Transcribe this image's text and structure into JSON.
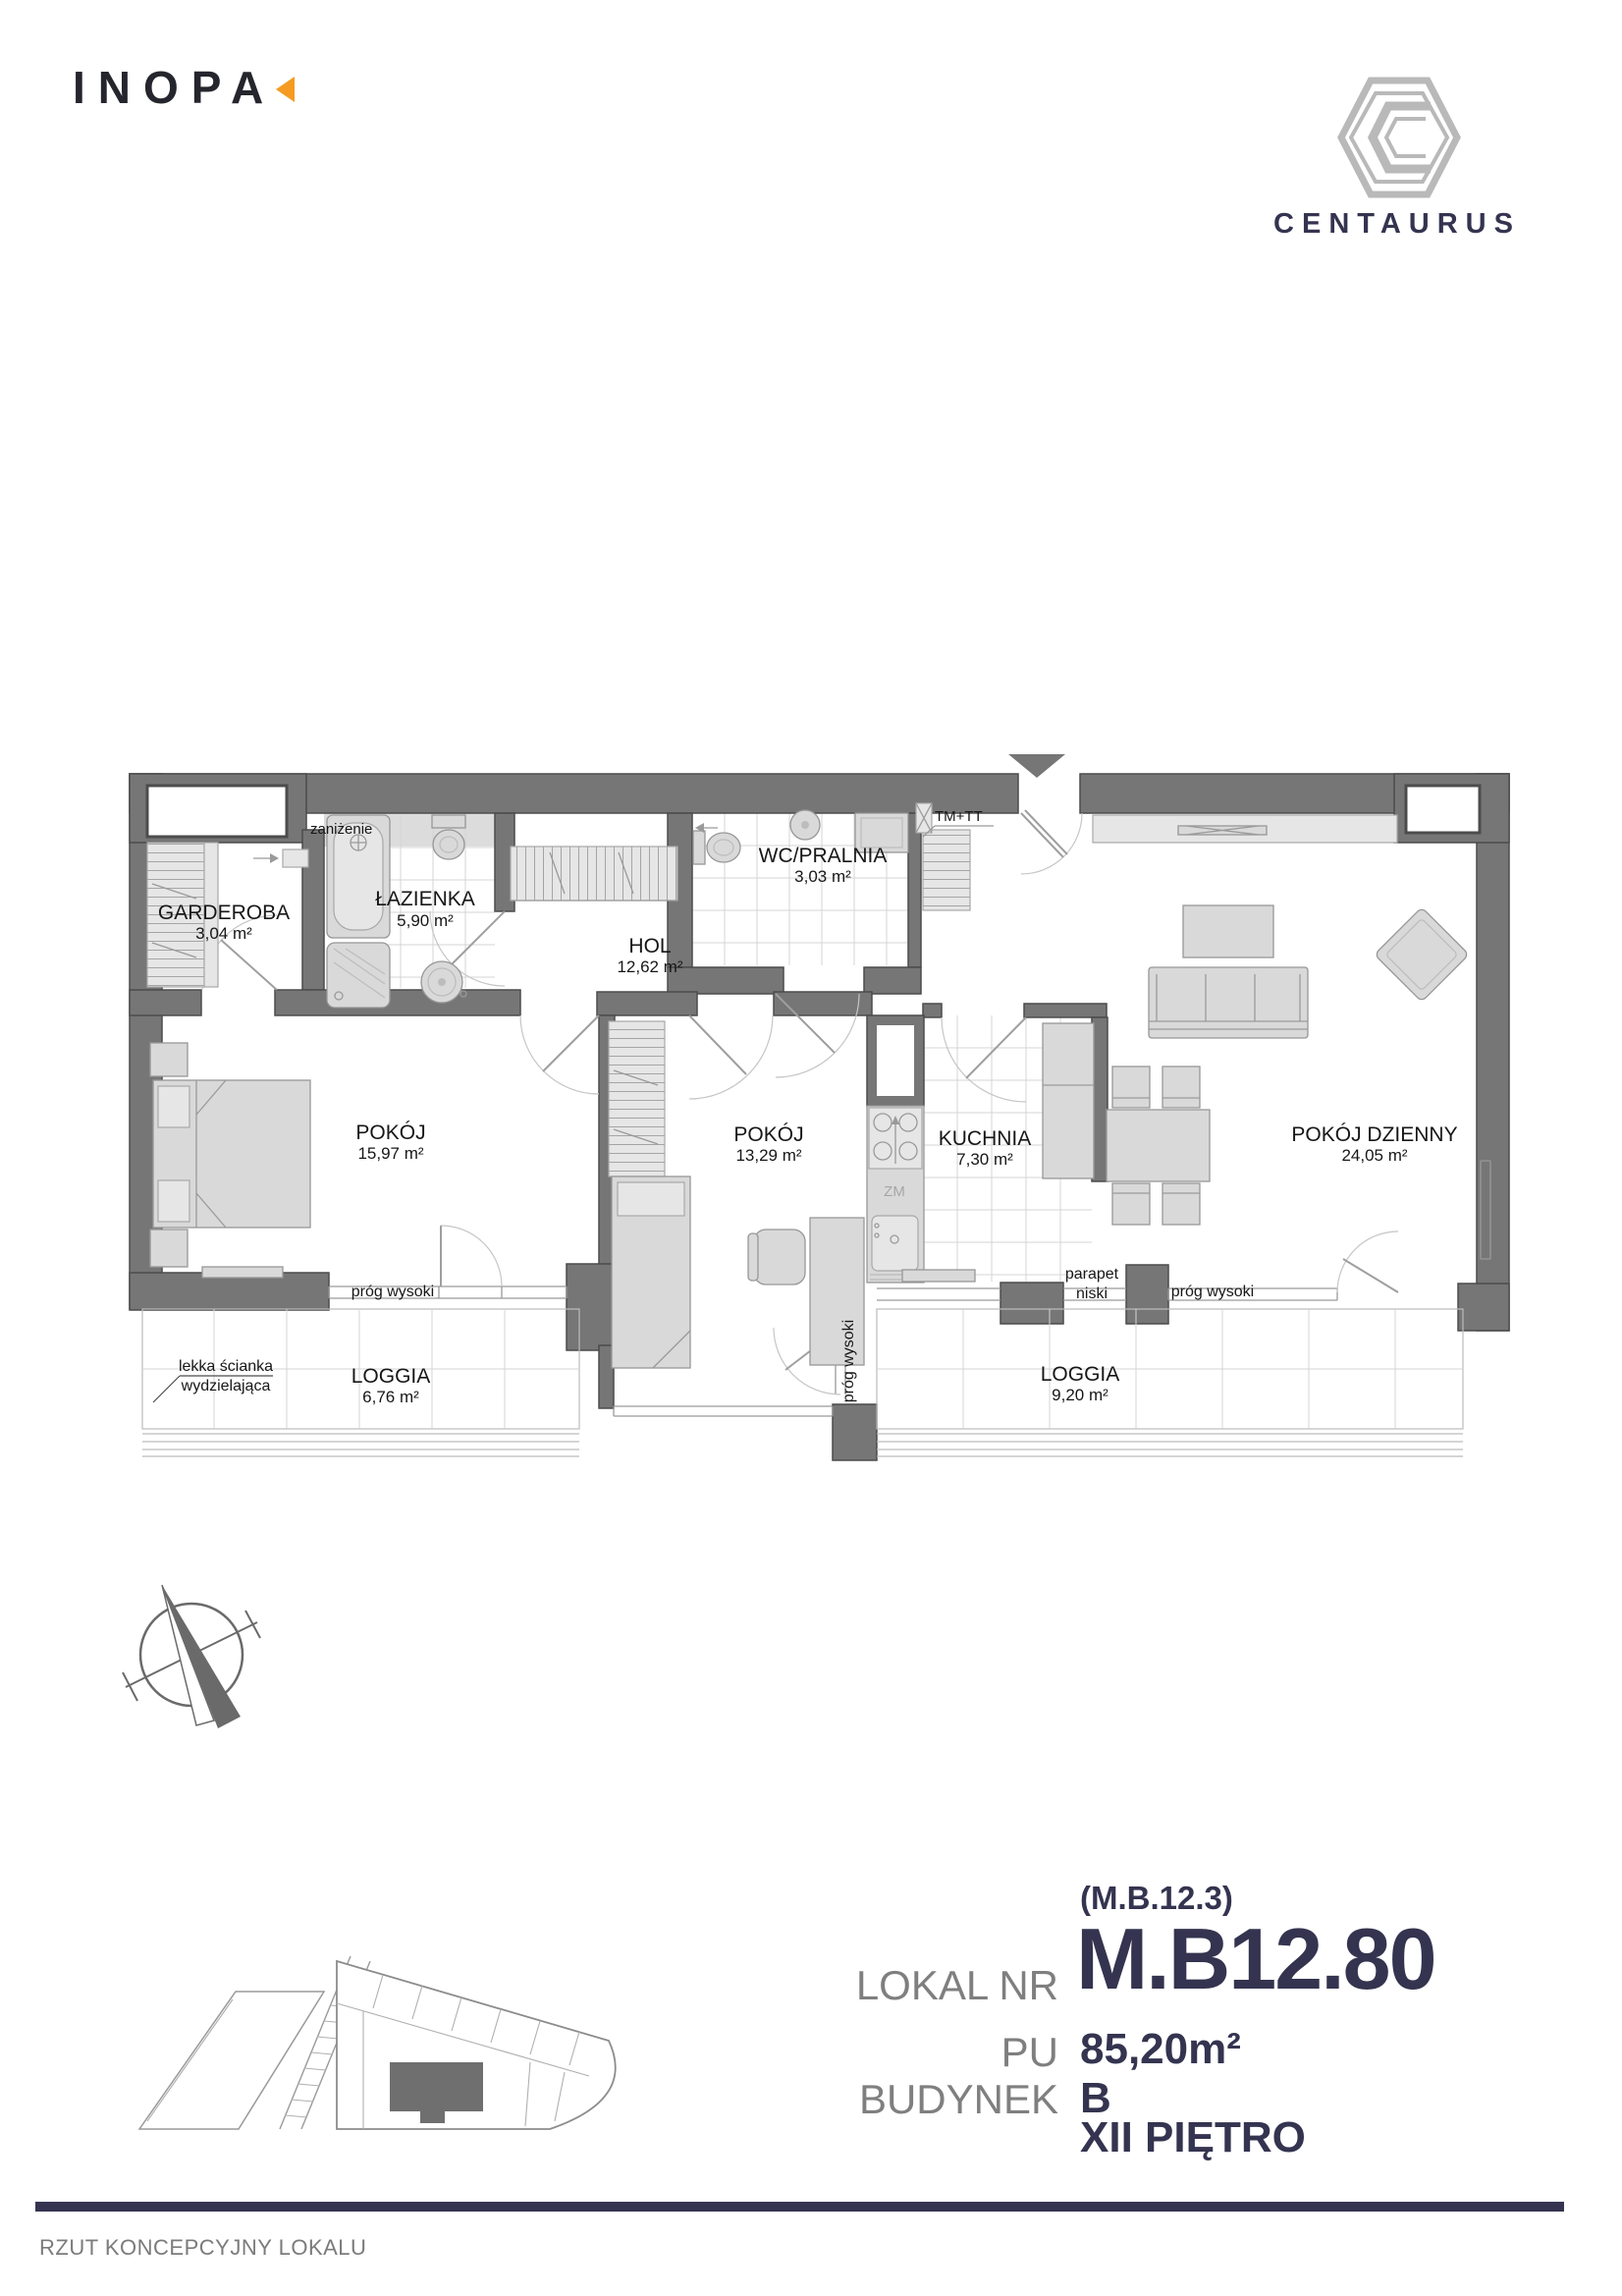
{
  "colors": {
    "navy": "#343450",
    "orange": "#f59b21",
    "label_gray": "#7f7f7f",
    "wall_gray": "#767676"
  },
  "header": {
    "inopa": "INOPA",
    "centaurus": "CENTAURUS"
  },
  "plan": {
    "rooms": [
      {
        "name": "GARDEROBA",
        "area": "3,04 m²"
      },
      {
        "name": "ŁAZIENKA",
        "area": "5,90 m²"
      },
      {
        "name": "HOL",
        "area": "12,62 m²"
      },
      {
        "name": "WC/PRALNIA",
        "area": "3,03 m²"
      },
      {
        "name": "POKÓJ",
        "area": "15,97 m²"
      },
      {
        "name": "POKÓJ",
        "area": "13,29 m²"
      },
      {
        "name": "KUCHNIA",
        "area": "7,30 m²"
      },
      {
        "name": "POKÓJ DZIENNY",
        "area": "24,05 m²"
      },
      {
        "name": "LOGGIA",
        "area": "6,76 m²"
      },
      {
        "name": "LOGGIA",
        "area": "9,20 m²"
      }
    ],
    "annotations": {
      "zanizenie": "zaniżenie",
      "tm_tt": "TM+TT",
      "zm": "ZM",
      "prog_wysoki_left": "próg wysoki",
      "prog_wysoki_mid": "próg wysoki",
      "prog_wysoki_right": "próg wysoki",
      "parapet_1": "parapet",
      "parapet_2": "niski",
      "lekka_1": "lekka ścianka",
      "lekka_2": "wydzielająca"
    }
  },
  "info": {
    "code": "(M.B.12.3)",
    "lokal_label": "LOKAL NR",
    "lokal_value": "M.B12.80",
    "pu_label": "PU",
    "pu_value": "85,20m²",
    "budynek_label": "BUDYNEK",
    "budynek_value": "B",
    "floor": "XII PIĘTRO"
  },
  "footer": {
    "caption": "RZUT KONCEPCYJNY LOKALU"
  }
}
